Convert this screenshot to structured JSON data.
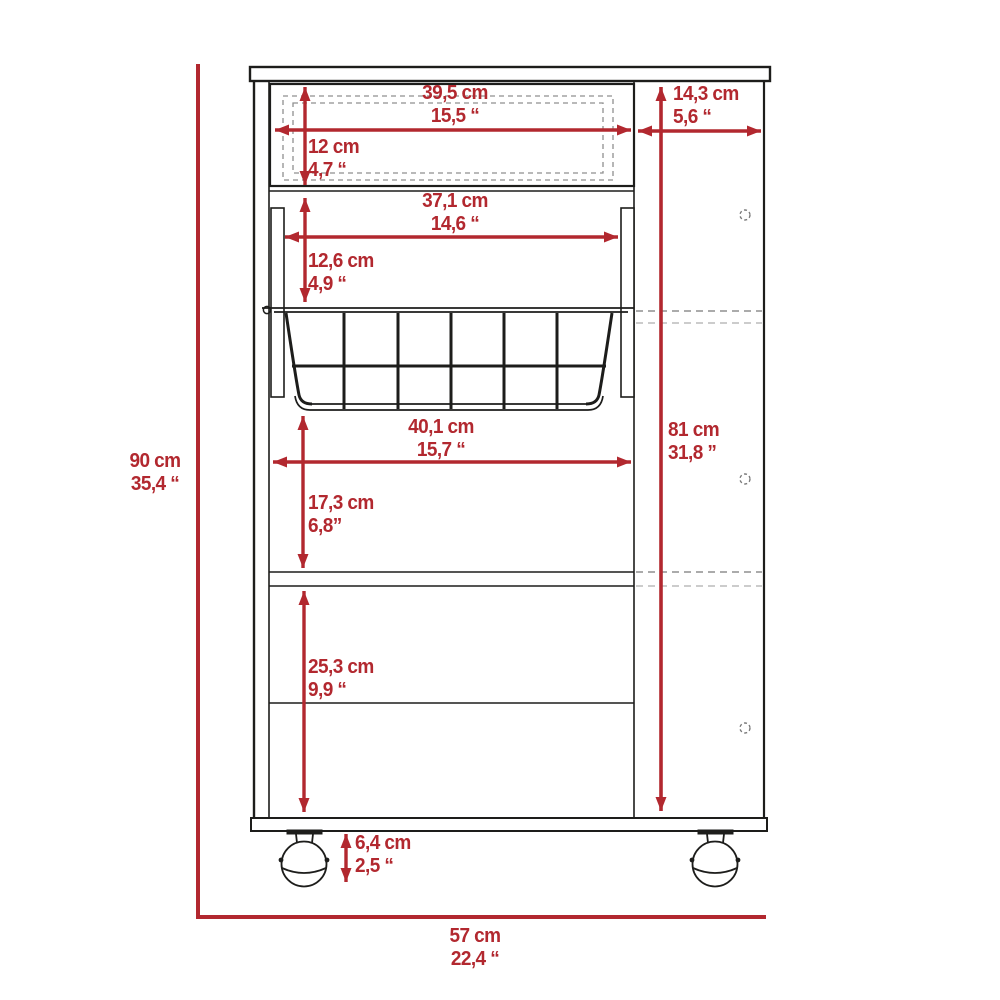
{
  "diagram_type": "furniture-dimension-drawing",
  "colors": {
    "dimension_red": "#b2282f",
    "line_black": "#1d1d1b",
    "hidden_dash_gray": "#8f8f8f",
    "hidden_dash_light": "#bcbcbc",
    "background": "#ffffff"
  },
  "dimensions": {
    "drawer_width": {
      "cm": "39,5 cm",
      "in": "15,5 “"
    },
    "side_depth": {
      "cm": "14,3 cm",
      "in": "5,6 “"
    },
    "drawer_height": {
      "cm": "12 cm",
      "in": "4,7 “"
    },
    "opening_width": {
      "cm": "37,1 cm",
      "in": "14,6 “"
    },
    "basket_section_height": {
      "cm": "12,6 cm",
      "in": "4,9 “"
    },
    "basket_width": {
      "cm": "40,1 cm",
      "in": "15,7 “"
    },
    "interior_height": {
      "cm": "81 cm",
      "in": "31,8 ”"
    },
    "shelf_gap_height": {
      "cm": "17,3 cm",
      "in": "6,8”"
    },
    "lower_section_height": {
      "cm": "25,3 cm",
      "in": "9,9 “"
    },
    "caster_height": {
      "cm": "6,4 cm",
      "in": "2,5 “"
    },
    "overall_height": {
      "cm": "90 cm",
      "in": "35,4 “"
    },
    "overall_width": {
      "cm": "57 cm",
      "in": "22,4 “"
    }
  }
}
